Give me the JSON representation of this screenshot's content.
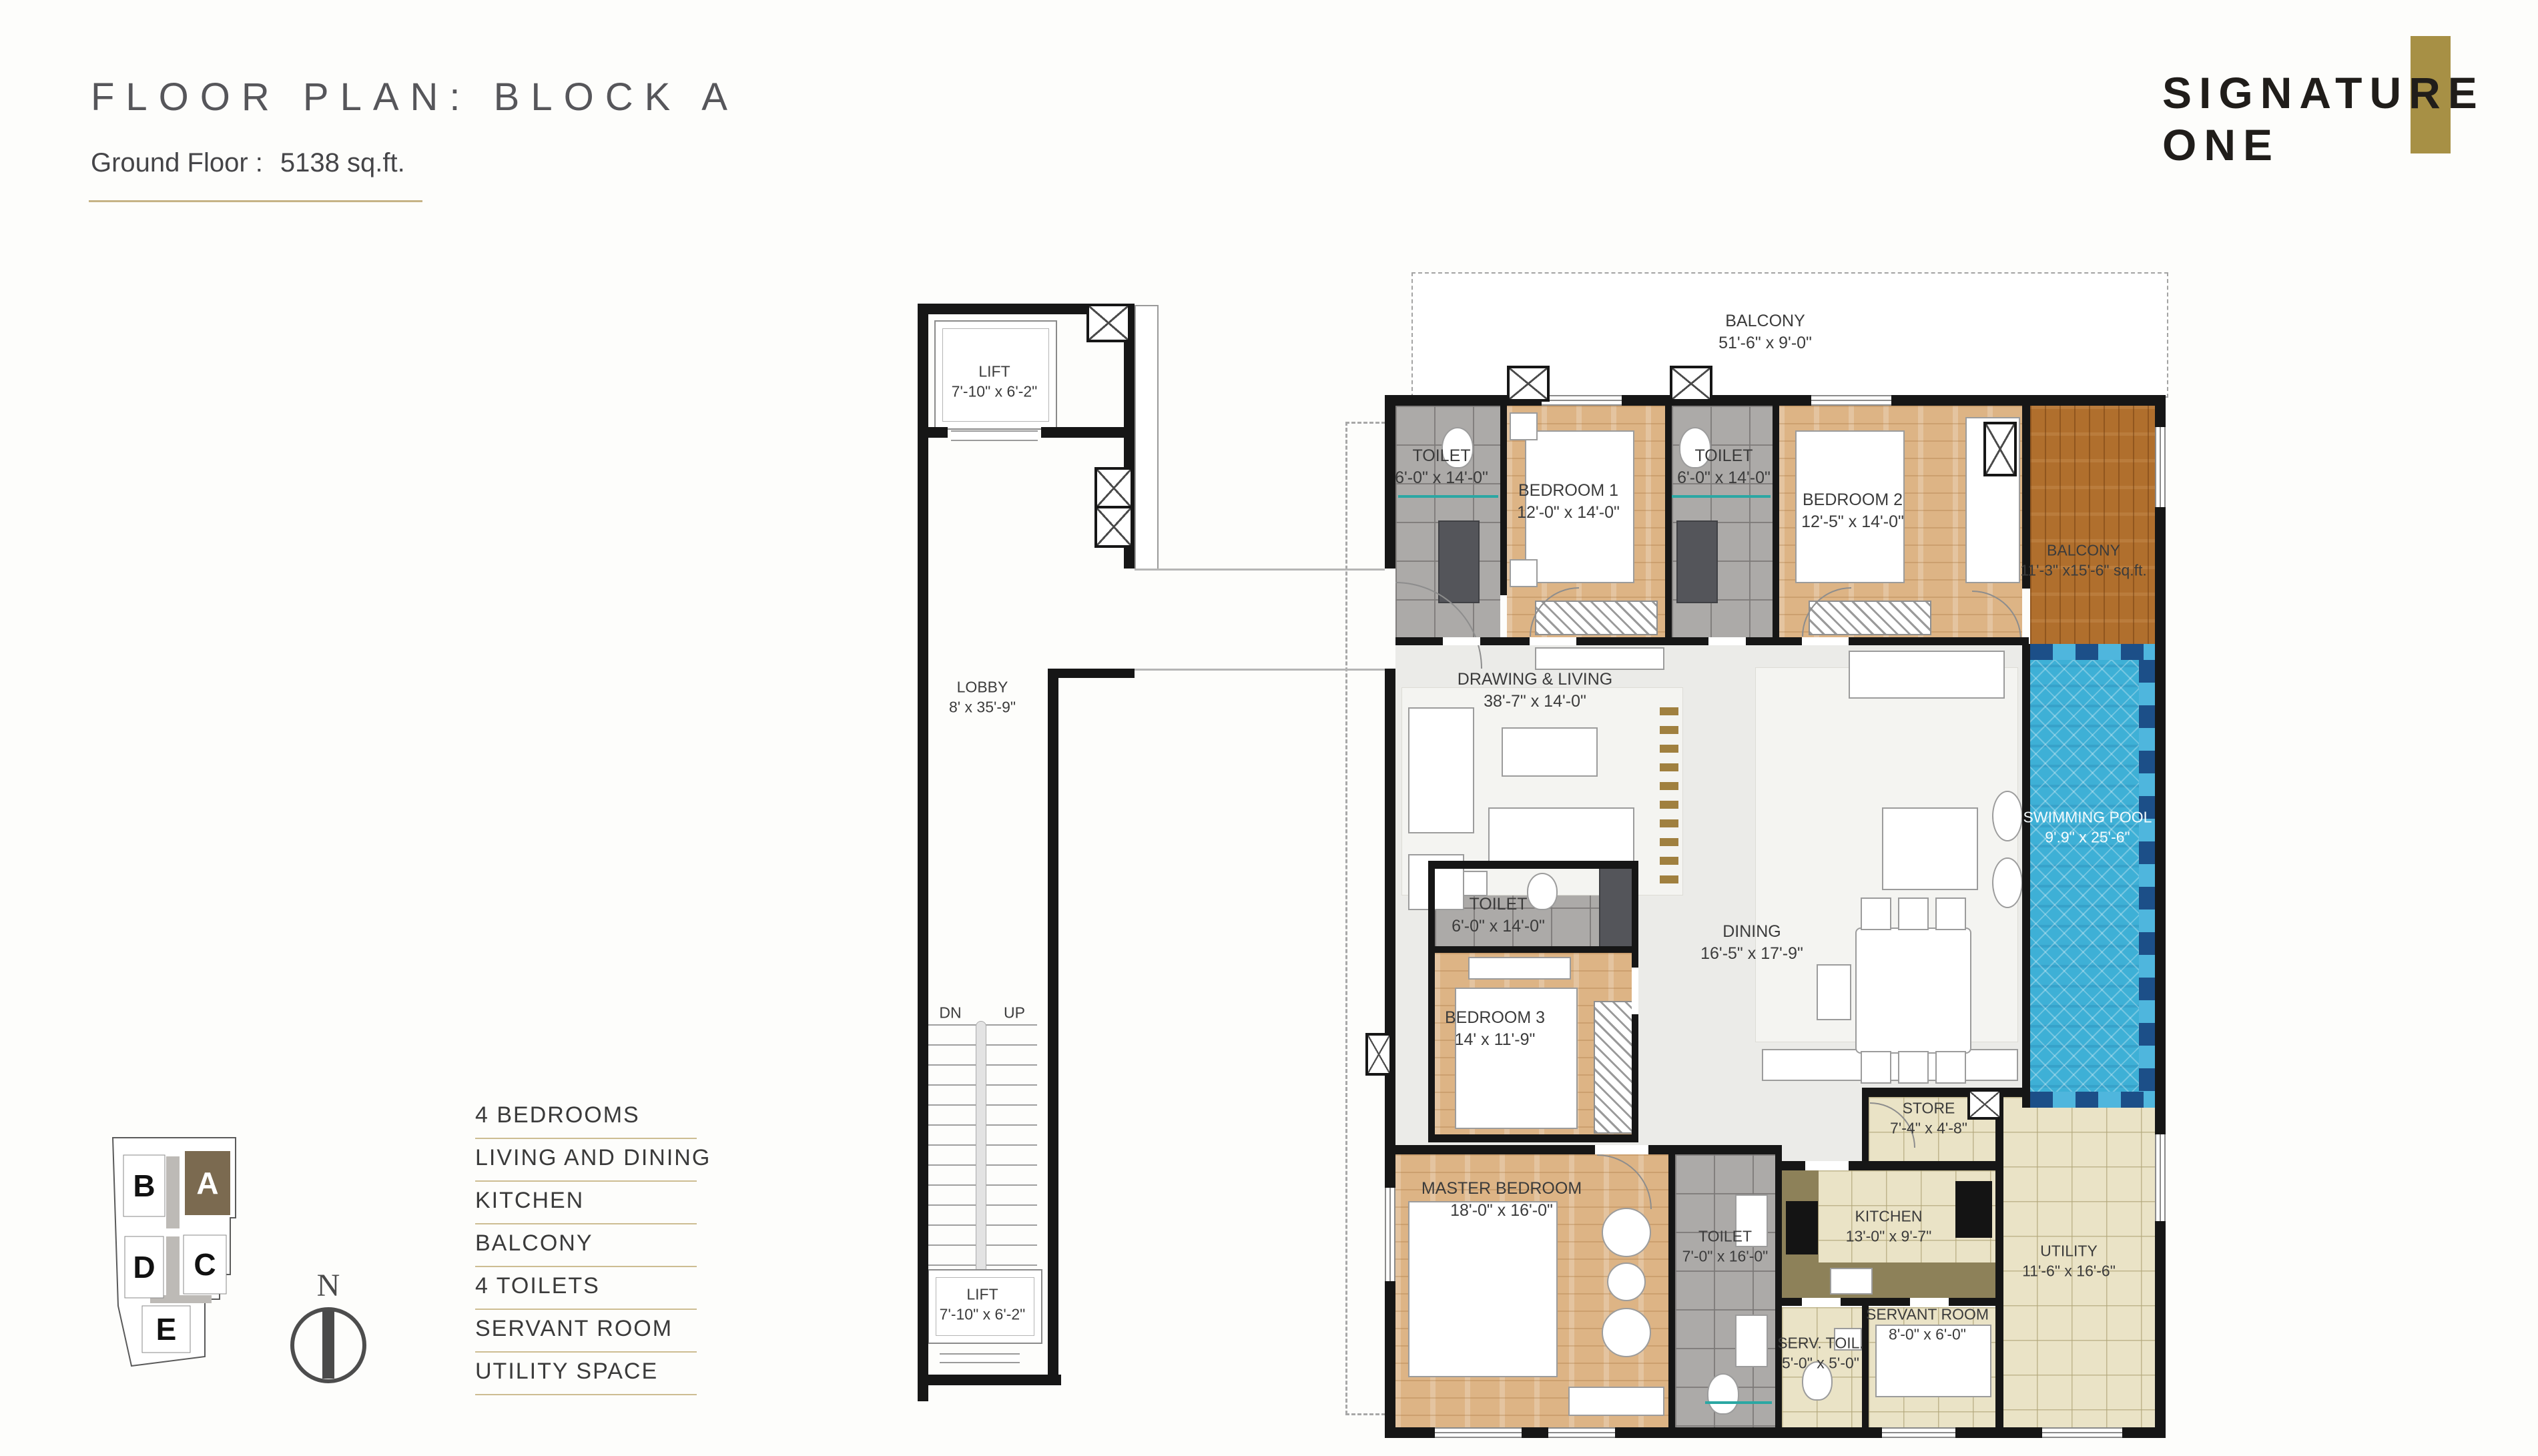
{
  "header": {
    "title": "FLOOR PLAN: BLOCK A",
    "floor_label": "Ground Floor :",
    "floor_area": "5138 sq.ft."
  },
  "logo": {
    "line1": "SIGNATURE",
    "line2": "ONE",
    "accent_color": "#a79045"
  },
  "legend": {
    "items": [
      "4 BEDROOMS",
      "LIVING AND DINING",
      "KITCHEN",
      "BALCONY",
      "4 TOILETS",
      "SERVANT ROOM",
      "UTILITY SPACE"
    ]
  },
  "key_plan": {
    "north_label": "N",
    "active_block": "A",
    "blocks": [
      {
        "id": "B"
      },
      {
        "id": "A"
      },
      {
        "id": "D"
      },
      {
        "id": "C"
      },
      {
        "id": "E"
      }
    ]
  },
  "core": {
    "lift_top": {
      "name": "LIFT",
      "dims": "7'-10\" x 6'-2\""
    },
    "lobby": {
      "name": "LOBBY",
      "dims": "8' x 35'-9\""
    },
    "stairs": {
      "down": "DN",
      "up": "UP"
    },
    "lift_bottom": {
      "name": "LIFT",
      "dims": "7'-10\" x 6'-2\""
    }
  },
  "rooms": {
    "balcony_top": {
      "name": "BALCONY",
      "dims": "51'-6\" x 9'-0\""
    },
    "toilet_1": {
      "name": "TOILET",
      "dims": "6'-0\" x 14'-0\""
    },
    "bedroom_1": {
      "name": "BEDROOM 1",
      "dims": "12'-0\" x 14'-0\""
    },
    "toilet_2": {
      "name": "TOILET",
      "dims": "6'-0\" x 14'-0\""
    },
    "bedroom_2": {
      "name": "BEDROOM 2",
      "dims": "12'-5\" x 14'-0\""
    },
    "balcony_right": {
      "name": "BALCONY",
      "dims": "11'-3\" x15'-6\" sq.ft."
    },
    "swimming_pool": {
      "name": "SWIMMING POOL",
      "dims": "9'.9\" x 25'-6\""
    },
    "drawing_living": {
      "name": "DRAWING & LIVING",
      "dims": "38'-7\" x 14'-0\""
    },
    "toilet_3": {
      "name": "TOILET",
      "dims": "6'-0\" x 14'-0\""
    },
    "bedroom_3": {
      "name": "BEDROOM 3",
      "dims": "14' x 11'-9\""
    },
    "dining": {
      "name": "DINING",
      "dims": "16'-5\" x 17'-9\""
    },
    "store": {
      "name": "STORE",
      "dims": "7'-4\" x 4'-8\""
    },
    "kitchen": {
      "name": "KITCHEN",
      "dims": "13'-0\" x 9'-7\""
    },
    "utility": {
      "name": "UTILITY",
      "dims": "11'-6\" x 16'-6\""
    },
    "master_bedroom": {
      "name": "MASTER BEDROOM",
      "dims": "18'-0\" x 16'-0\""
    },
    "master_toilet": {
      "name": "TOILET",
      "dims": "7'-0\" x 16'-0\""
    },
    "servant_room": {
      "name": "SERVANT ROOM",
      "dims": "8'-0\" x 6'-0\""
    },
    "servant_toilet": {
      "name": "SERV. TOIL.",
      "dims": "5'-0\" x 5'-0\""
    }
  },
  "colors": {
    "accent_gold": "#a79045",
    "underline_gold": "#c6b386",
    "wall": "#161616",
    "pool_blue": "#3eb0d6",
    "wood_light": "#ddb485",
    "wood_dark": "#b06f2d",
    "tile_gray": "#acaaa8",
    "tile_beige": "#eae3c6",
    "key_plan_active": "#7b6a50"
  }
}
